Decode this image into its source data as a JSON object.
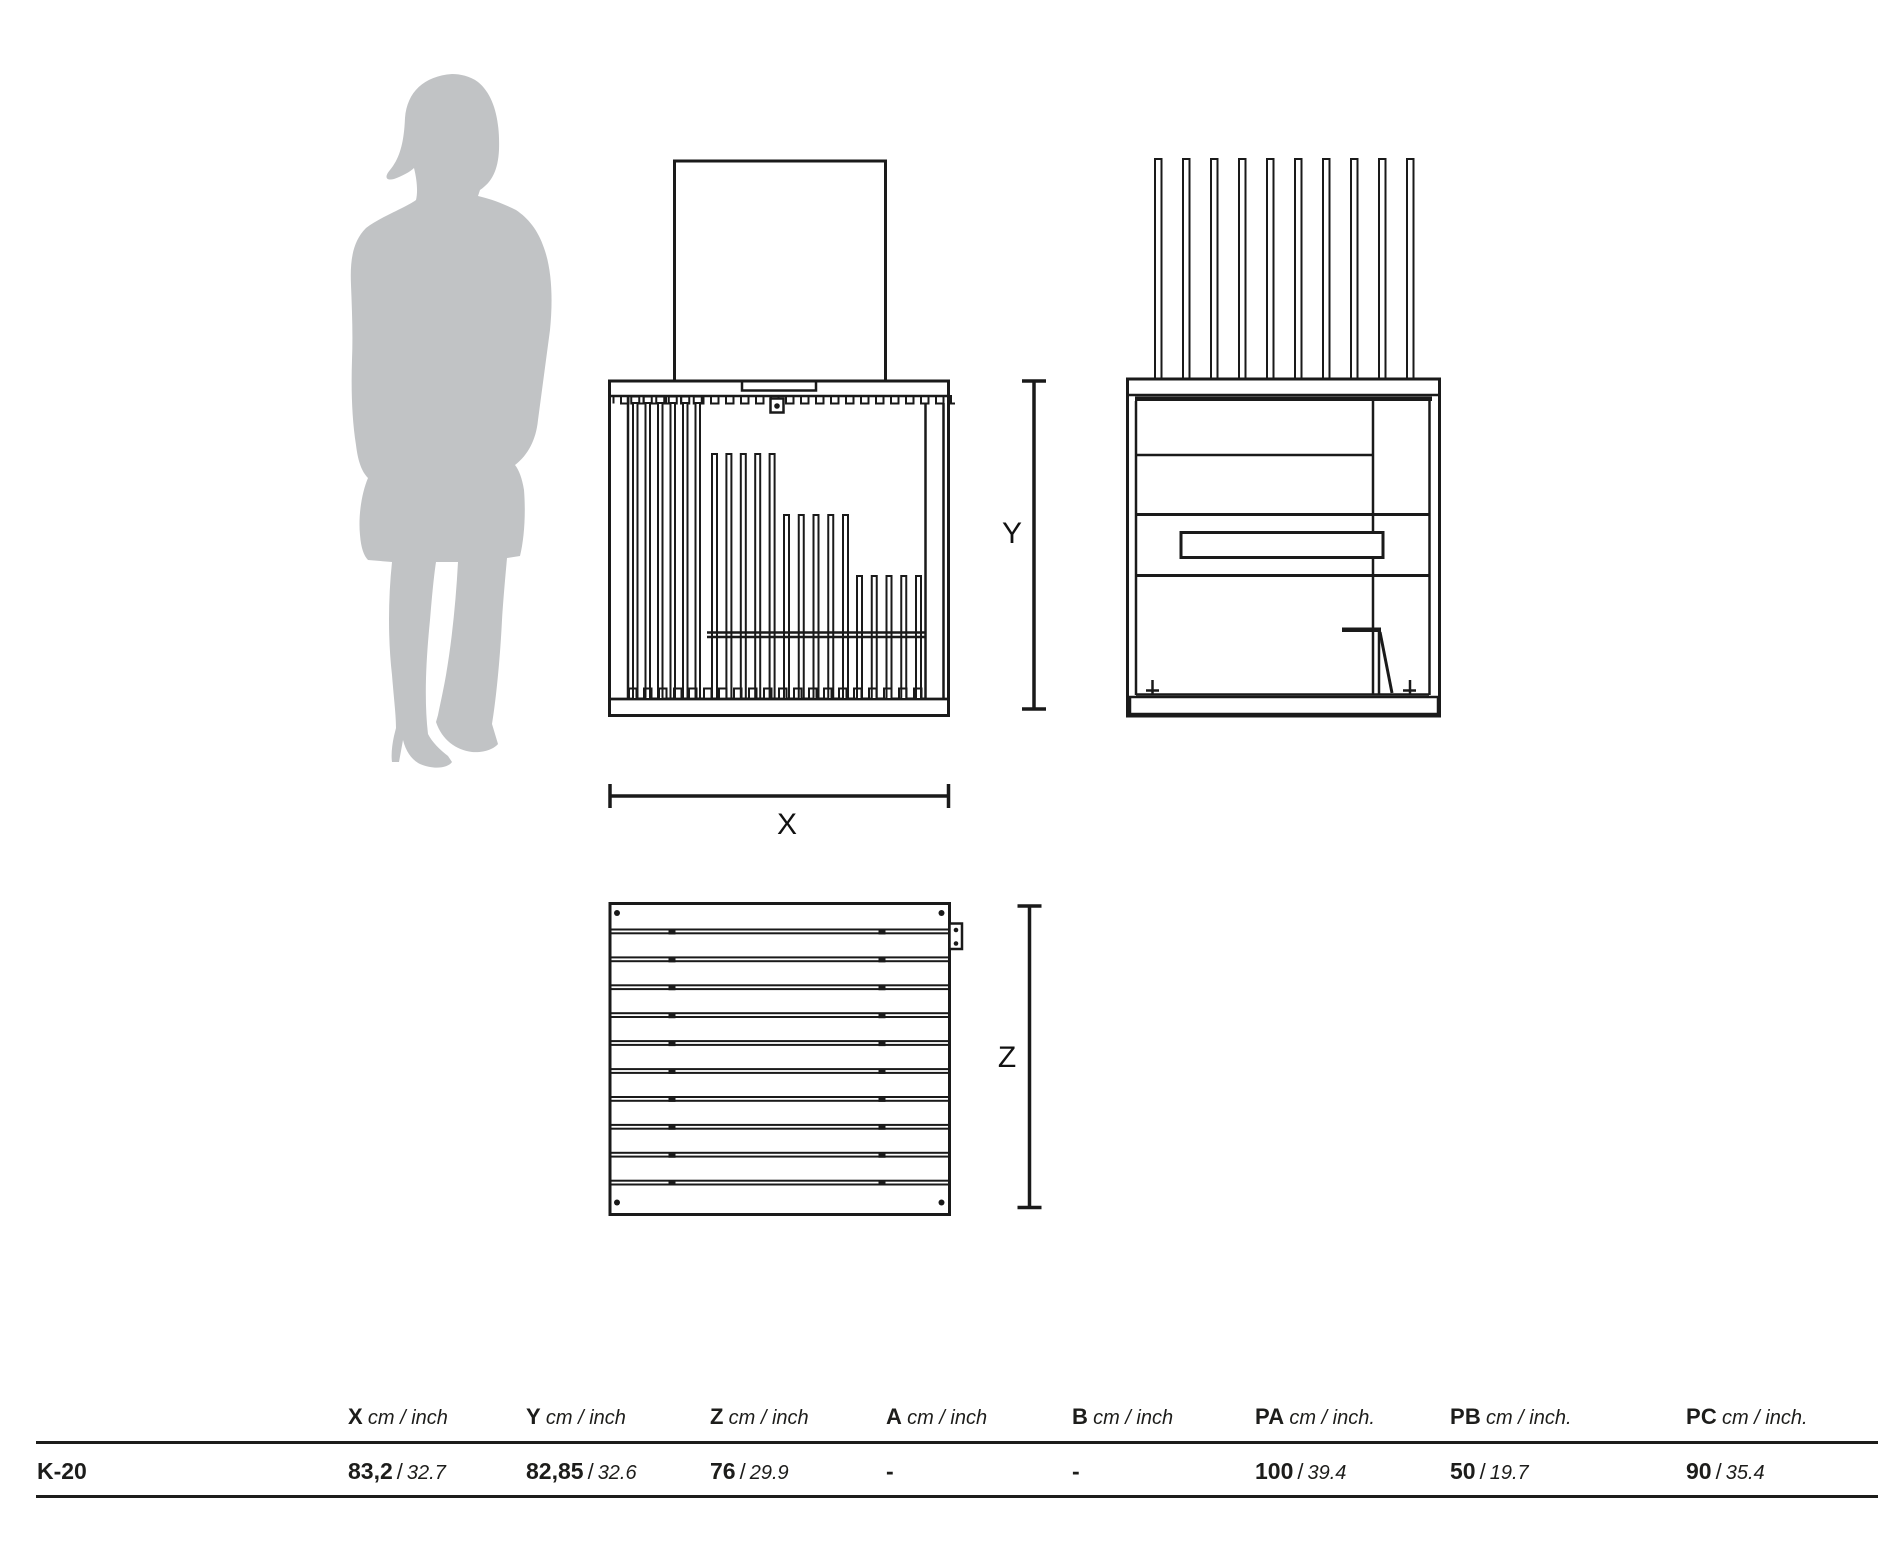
{
  "dimensions": {
    "x": "X",
    "y": "Y",
    "z": "Z"
  },
  "table": {
    "row_name": "K-20",
    "columns": [
      {
        "label": "X",
        "unit": "cm / inch",
        "cm": "83,2",
        "sep": "/",
        "inch": "32.7"
      },
      {
        "label": "Y",
        "unit": "cm / inch",
        "cm": "82,85",
        "sep": "/",
        "inch": "32.6"
      },
      {
        "label": "Z",
        "unit": "cm / inch",
        "cm": "76",
        "sep": "/",
        "inch": "29.9"
      },
      {
        "label": "A",
        "unit": "cm / inch",
        "cm": "-",
        "sep": "",
        "inch": ""
      },
      {
        "label": "B",
        "unit": "cm / inch",
        "cm": "-",
        "sep": "",
        "inch": ""
      },
      {
        "label": "PA",
        "unit": "cm / inch.",
        "cm": "100",
        "sep": "/",
        "inch": "39.4"
      },
      {
        "label": "PB",
        "unit": "cm / inch.",
        "cm": "50",
        "sep": "/",
        "inch": "19.7"
      },
      {
        "label": "PC",
        "unit": "cm / inch.",
        "cm": "90",
        "sep": "/",
        "inch": "35.4"
      }
    ]
  }
}
